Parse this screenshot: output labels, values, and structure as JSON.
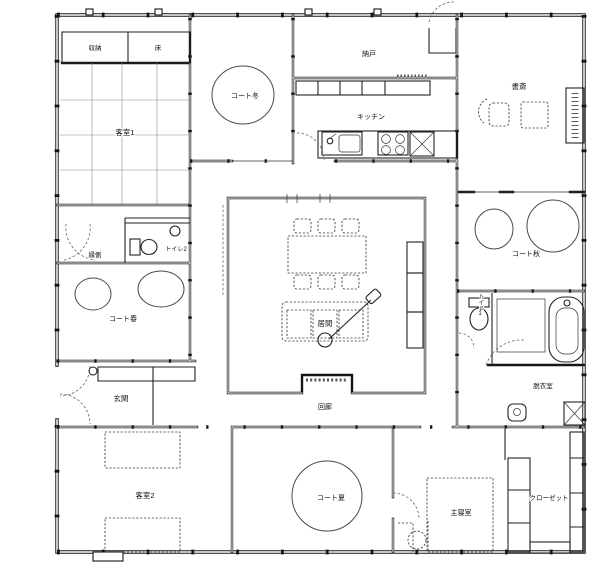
{
  "plan": {
    "type": "architectural-floor-plan",
    "colors": {
      "line": "#161616",
      "background": "#ffffff",
      "furniture_dash": "#3a3a3a"
    },
    "rooms": {
      "storage1": "収納",
      "toko": "床",
      "guest1": "客室1",
      "court_winter": "コート冬",
      "nando": "納戸",
      "kitchen": "キッチン",
      "study": "書斎",
      "engawa": "縁側",
      "toilet2": "トイレ2",
      "court_spring": "コート春",
      "court_autumn": "コート秋",
      "living": "居間",
      "corridor": "回廊",
      "toilet1": "トイレ1",
      "dressing": "脱衣室",
      "entrance": "玄関",
      "guest2": "客室2",
      "court_summer": "コート夏",
      "master": "主寝室",
      "closet": "クローゼット"
    },
    "fixtures": [
      "tree",
      "dining-table",
      "dining-chair",
      "sofa",
      "floor-lamp",
      "kitchen-sink",
      "stove",
      "bathtub",
      "toilet",
      "washbasin",
      "bed",
      "futon",
      "shoe-cabinet",
      "closet-shelves",
      "desk",
      "wall-post",
      "door-swing"
    ]
  }
}
